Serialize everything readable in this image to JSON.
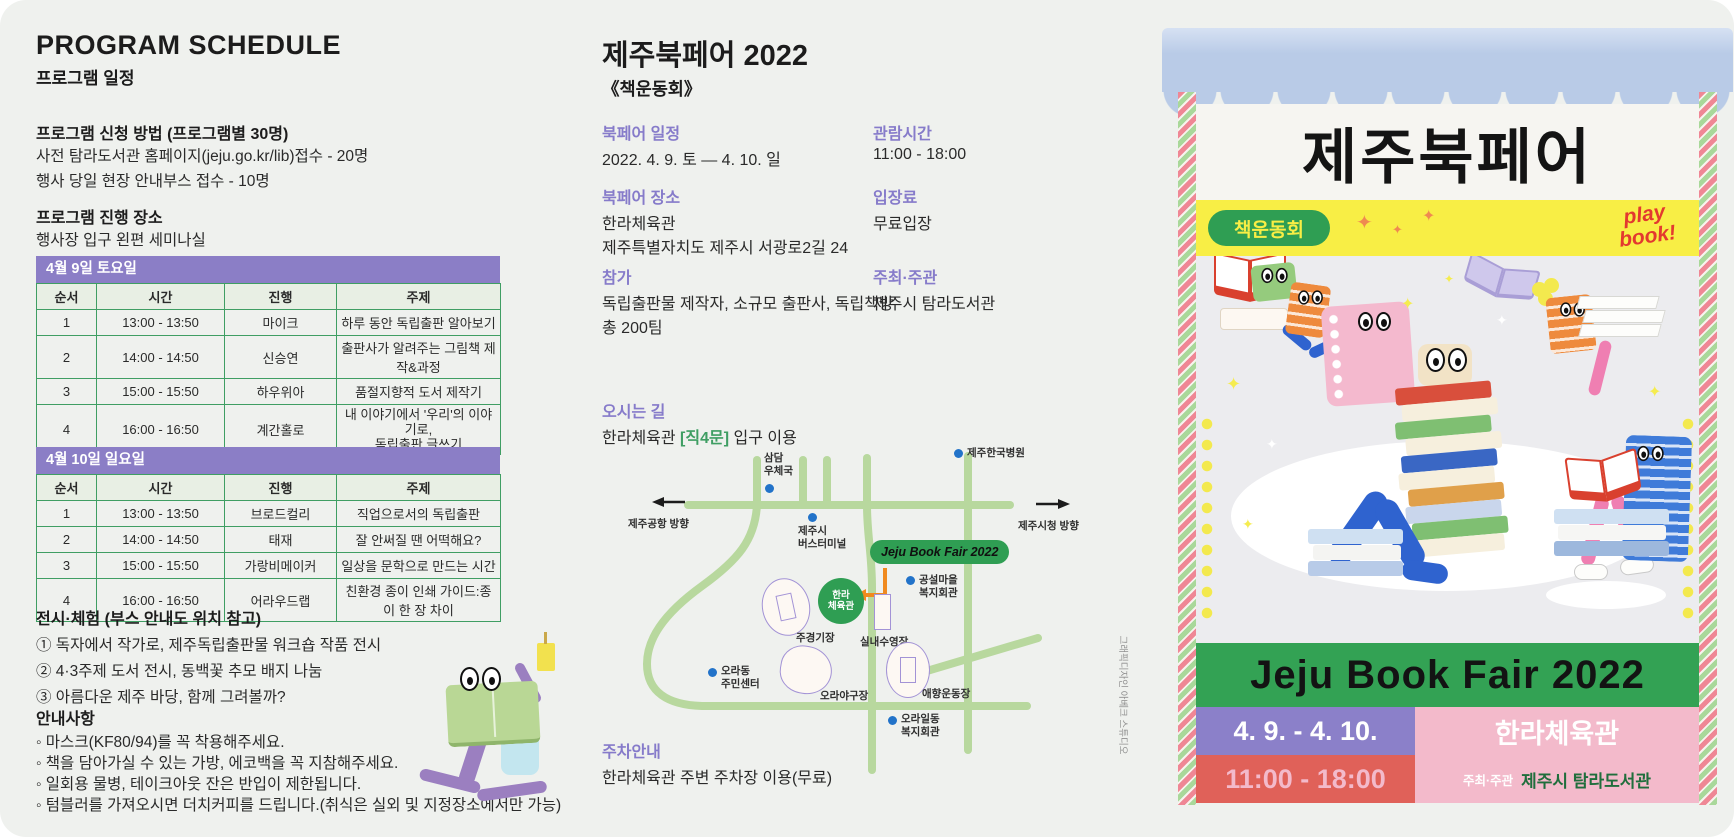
{
  "colors": {
    "accent_purple": "#8b7ec6",
    "accent_green": "#3f9e63",
    "map_road": "#b8d89e",
    "map_dot_blue": "#2273c9",
    "poster_green": "#33a254",
    "poster_purple": "#8b80c9",
    "poster_pink": "#f3bacb",
    "poster_red": "#e06159",
    "poster_yellow": "#f8ee45"
  },
  "left": {
    "title": "PROGRAM SCHEDULE",
    "subtitle": "프로그램 일정",
    "apply_heading": "프로그램 신청 방법 (프로그램별 30명)",
    "apply_line1": "사전 탐라도서관 홈페이지(jeju.go.kr/lib)접수 - 20명",
    "apply_line2": "행사 당일 현장 안내부스 접수 - 10명",
    "venue_heading": "프로그램 진행 장소",
    "venue_line": "행사장 입구 왼편 세미나실",
    "tables": [
      {
        "day": "4월 9일 토요일",
        "columns": [
          "순서",
          "시간",
          "진행",
          "주제"
        ],
        "rows": [
          [
            "1",
            "13:00 - 13:50",
            "마이크",
            "하루 동안 독립출판 알아보기"
          ],
          [
            "2",
            "14:00 - 14:50",
            "신승연",
            "출판사가 알려주는 그림책 제작&과정"
          ],
          [
            "3",
            "15:00 - 15:50",
            "하우위아",
            "품절지향적 도서 제작기"
          ],
          [
            "4",
            "16:00 - 16:50",
            "계간홀로",
            "내 이야기에서 '우리'의 이야기로,\n독립출판 글쓰기"
          ]
        ]
      },
      {
        "day": "4월 10일 일요일",
        "columns": [
          "순서",
          "시간",
          "진행",
          "주제"
        ],
        "rows": [
          [
            "1",
            "13:00 - 13:50",
            "브로드컬리",
            "직업으로서의 독립출판"
          ],
          [
            "2",
            "14:00 - 14:50",
            "태재",
            "잘 안써질 땐 어떡해요?"
          ],
          [
            "3",
            "15:00 - 15:50",
            "가랑비메이커",
            "일상을 문학으로 만드는 시간"
          ],
          [
            "4",
            "16:00 - 16:50",
            "어라우드랩",
            "친환경 종이 인쇄 가이드:종이 한 장 차이"
          ]
        ]
      }
    ],
    "exhibit_heading": "전시·체험 (부스 안내도 위치 참고)",
    "exhibit_items": [
      "① 독자에서 작가로, 제주독립출판물 워크숍 작품 전시",
      "② 4·3주제 도서 전시, 동백꽃 추모 배지 나눔",
      "③ 아름다운 제주 바당, 함께 그려볼까?"
    ],
    "notice_heading": "안내사항",
    "notice_items": [
      "◦ 마스크(KF80/94)를 꼭 착용해주세요.",
      "◦ 책을 담아가실 수 있는 가방, 에코백을 꼭 지참해주세요.",
      "◦ 일회용 물병, 테이크아웃 잔은 반입이 제한됩니다.",
      "◦ 텀블러를 가져오시면 더치커피를 드립니다.(취식은 실외 및 지정장소에서만 가능)"
    ]
  },
  "middle": {
    "title": "제주북페어 2022",
    "subtitle": "《책운동회》",
    "schedule_label": "북페어 일정",
    "schedule_value": "2022. 4. 9. 토 — 4. 10. 일",
    "hours_label": "관람시간",
    "hours_value": "11:00 - 18:00",
    "place_label": "북페어 장소",
    "place_value1": "한라체육관",
    "place_value2": "제주특별자치도 제주시 서광로2길 24",
    "fee_label": "입장료",
    "fee_value": "무료입장",
    "join_label": "참가",
    "join_value1": "독립출판물 제작자, 소규모 출판사, 독립책방",
    "join_value2": "총 200팀",
    "host_label": "주최·주관",
    "host_value": "제주시 탐라도서관",
    "way_label": "오시는 길",
    "way_pre": "한라체육관 ",
    "way_gate": "[직4문]",
    "way_post": " 입구 이용",
    "parking_label": "주차안내",
    "parking_value": "한라체육관 주변 주차장 이용(무료)",
    "credit": "그래픽디자인 아베크 스튜디오",
    "map": {
      "fair_badge": "Jeju Book Fair 2022",
      "venue_circle": "한라\n체육관",
      "dir_left": "제주공항 방향",
      "dir_right": "제주시청 방향",
      "poi_post_office": "삼담\n우체국",
      "poi_hospital": "제주한국병원",
      "poi_terminal": "제주시\n버스터미널",
      "poi_gongseol": "공설마을\n복지회관",
      "poi_ora_center": "오라동\n주민센터",
      "poi_ora_welfare": "오라일동\n복지회관",
      "lbl_stadium": "주경기장",
      "lbl_pool": "실내수영장",
      "lbl_baseball": "오라야구장",
      "lbl_aehyang": "애향운동장"
    }
  },
  "poster": {
    "sign": "제주북페어",
    "badge_left": "책운동회",
    "badge_right": "play book!",
    "title_band": "Jeju Book Fair 2022",
    "date": "4. 9. - 4. 10.",
    "venue": "한라체육관",
    "time": "11:00 - 18:00",
    "host_label": "주최·주관",
    "host_value": "제주시 탐라도서관"
  }
}
